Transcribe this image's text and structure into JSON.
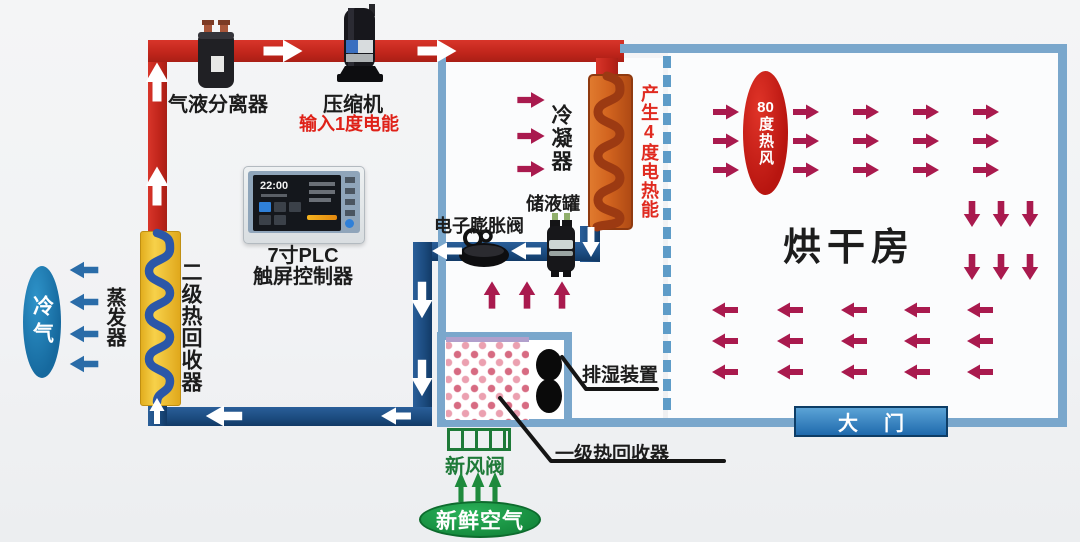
{
  "refrigeration": {
    "separator": "气液分离器",
    "compressor": "压缩机",
    "compressor_input": "输入1度电能",
    "condenser": "冷凝器",
    "condenser_energy": "产生4度电热能",
    "receiver": "储液罐",
    "expansion_valve": "电子膨胀阀",
    "evaporator": "蒸发器",
    "secondary_recovery": "二级热回收器"
  },
  "controller": {
    "line1": "7寸PLC",
    "line2": "触屏控制器",
    "time": "22:00"
  },
  "air": {
    "cold_air": "冷气",
    "hot_air_value": "80",
    "hot_air_suffix": "度热风",
    "fresh_air_valve": "新风阀",
    "fresh_air": "新鲜空气"
  },
  "room": {
    "name": "烘干房",
    "door": "大门",
    "dehumidifier": "排湿装置",
    "primary_recovery": "一级热回收器"
  },
  "colors": {
    "pipe_hot": "#c0251b",
    "pipe_cold": "#1b4a7e",
    "wall": "#7aa7cc",
    "arrow_white": "#ffffff",
    "arrow_crimson": "#a91a4e",
    "arrow_blue": "#2a6ca8",
    "arrow_green": "#1e8a3c",
    "hot_text": "#df2118",
    "green_text": "#1e7a38"
  }
}
